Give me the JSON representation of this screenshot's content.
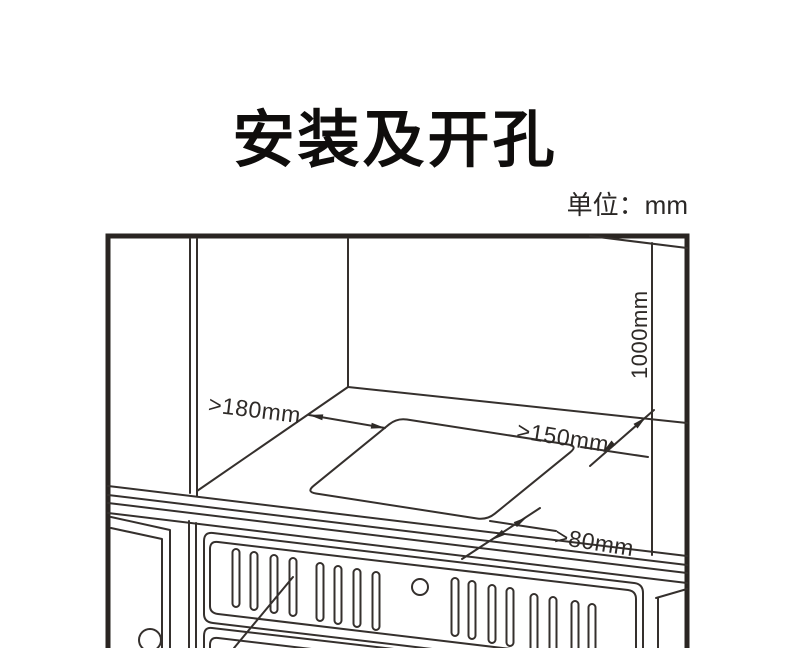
{
  "page": {
    "title": "安装及开孔",
    "unit_label": "单位：mm"
  },
  "diagram": {
    "description_labels": {},
    "dimensions": {
      "left_clearance": ">180mm",
      "right_clearance": ">150mm",
      "front_clearance": ">80mm",
      "height_clearance": "1000mm"
    },
    "colors": {
      "line": "#35302d",
      "text": "#1c1a19",
      "background": "#ffffff"
    }
  }
}
